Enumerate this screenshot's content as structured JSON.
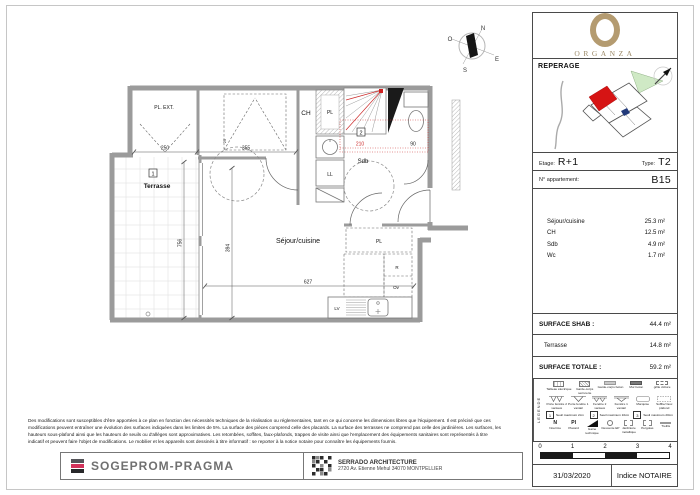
{
  "plan": {
    "labels": {
      "pl_ext": "PL. EXT.",
      "ch": "CH",
      "pl": "PL",
      "sdb": "Sdb",
      "ll": "LL",
      "sejour": "Séjour/cuisine",
      "terrasse": "Terrasse",
      "pl_entree": "PL",
      "lv": "LV",
      "r": "R",
      "ov": "Ov"
    },
    "dims": {
      "pl_ext_w": "250",
      "ch_w": "355",
      "niche": "25",
      "sdb_w": "210",
      "wc_w": "90",
      "sejour_w": "627",
      "sejour_h": "394",
      "terrasse_h": "756"
    },
    "markers": {
      "seuil_terrasse": "1",
      "seuil_sdb": "2"
    },
    "compass": {
      "n": "N",
      "o": "O",
      "e": "E",
      "s": "S"
    },
    "accent_red": "#cc2a2a",
    "wall_gray": "#9b9b9b"
  },
  "sidebar": {
    "logo": {
      "brand": "ORGANZA",
      "gold": "#b49b70"
    },
    "reperage_title": "REPERAGE",
    "etage_label": "Etage:",
    "etage_value": "R+1",
    "type_label": "Type:",
    "type_value": "T2",
    "apartment_label": "N° appartement:",
    "apartment_value": "B15",
    "areas": [
      {
        "label": "Séjour/cuisine",
        "value": "25.3 m²"
      },
      {
        "label": "CH",
        "value": "12.5 m²"
      },
      {
        "label": "Sdb",
        "value": "4.9 m²"
      },
      {
        "label": "Wc",
        "value": "1.7 m²"
      }
    ],
    "shab_label": "SURFACE SHAB :",
    "shab_value": "44.4 m²",
    "terrasse_label": "Terrasse",
    "terrasse_value": "14.8 m²",
    "totale_label": "SURFACE TOTALE :",
    "totale_value": "59.2 m²",
    "legend": {
      "title": "LEGENDE",
      "row1": [
        "Tableau électrique",
        "Garde-corps serrurerie",
        "Garde-corps béton",
        "Mur béton",
        "grille clôture"
      ],
      "row2": [
        "Porte fenêtre 2 vantaux",
        "Porte fenêtre 1 vantail",
        "Fenêtre 2 vantaux",
        "Fenêtre 1 vantail",
        "Marquise",
        "Soffite/ faux plafond"
      ],
      "row3": [
        {
          "num": "1",
          "label": "Seuil maximum 2cm"
        },
        {
          "num": "2",
          "label": "Seuil maximum 10cm"
        },
        {
          "num": "3",
          "label": "Seuil maximum 20cm"
        }
      ],
      "row4": [
        {
          "sym": "N",
          "label": "Nourrice"
        },
        {
          "sym": "Pl",
          "label": "Placard"
        },
        {
          "sym": "",
          "label": "Gaine technique"
        },
        {
          "sym": "",
          "label": "Descente EP"
        },
        {
          "sym": "",
          "label": "Jardinière métallique"
        },
        {
          "sym": "",
          "label": "Pergolas"
        },
        {
          "sym": "",
          "label": "Treillis"
        }
      ]
    },
    "scale": {
      "ticks": [
        "0",
        "1",
        "2",
        "3",
        "4"
      ]
    },
    "date": "31/03/2020",
    "indice": "Indice NOTAIRE"
  },
  "footer": {
    "disclaimer": [
      "Des modifications sont susceptibles d'être apportées à ce plan en fonction des nécessités techniques de la réalisation ou réglementaires, tant en ce qui concerne les dimensions libres que l'équipement. Il est précisé que ces",
      "modifications peuvent entraîner une évolution des surfaces indiquées dans les limites de 5%. La surface des pièces comprend celle des placards. La surface des terrasses ne comprend pas celle des jardinières. Les surfaces, les",
      "hauteurs sous-plafond ainsi que les hauteurs de seuils ou d'allèges sont approximatives. Les retombées, soffites, faux-plafonds, trappes de visite ainsi que l'emplacement des équipements sanitaires sont représentés à titre",
      "indicatif et peuvent faire l'objet de modifications. Le mobilier et les appareils sont dessinés à titre informatif : se reporter à la notice notaire pour connaître les équipements fournis."
    ],
    "developer": "SOGEPROM-PRAGMA",
    "architect_name": "SERRADO ARCHITECTURE",
    "architect_address": "2720 Av. Etienne Mehul 34070 MONTPELLIER"
  }
}
